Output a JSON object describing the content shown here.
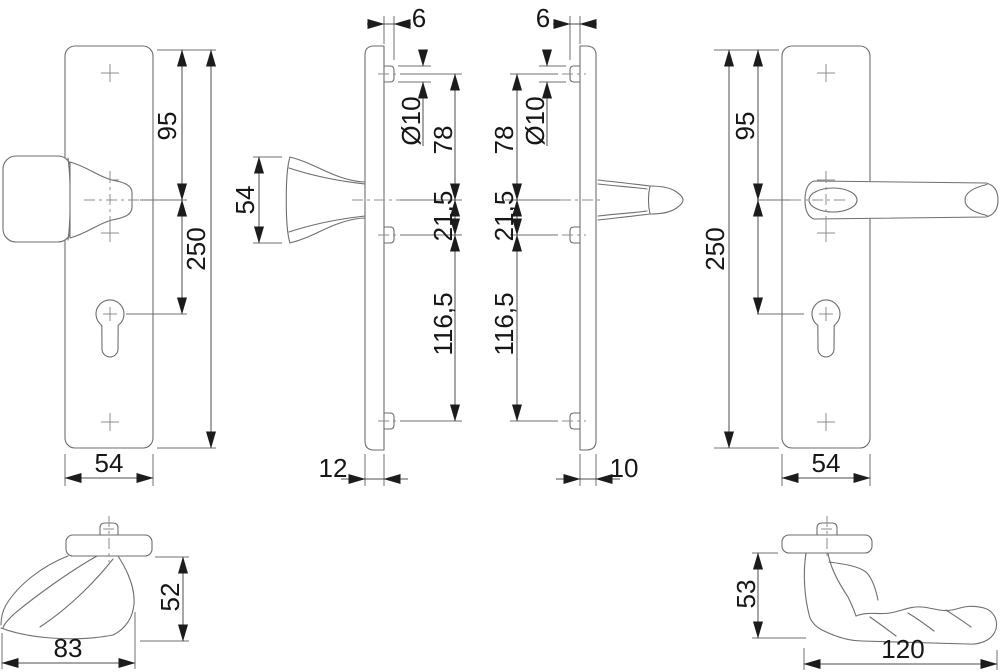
{
  "drawing": {
    "colors": {
      "background": "#ffffff",
      "geometry_line": "#6e6e6e",
      "dimension_line": "#4d4d4d",
      "text": "#161616"
    },
    "views": {
      "front_knob": {
        "labels": {
          "top_to_handle": "95",
          "plate_height": "250",
          "plate_width": "54"
        }
      },
      "side_knob": {
        "labels": {
          "bushing_protrusion": "6",
          "bushing_diameter": "Ø10",
          "knob_height": "54",
          "top_to_handle": "78",
          "handle_to_fixing": "21,5",
          "fixing_to_bottom": "116,5",
          "plate_depth": "12"
        }
      },
      "side_lever": {
        "labels": {
          "bushing_protrusion": "6",
          "bushing_diameter": "Ø10",
          "top_to_handle": "78",
          "handle_to_fixing": "21,5",
          "fixing_to_bottom": "116,5",
          "plate_depth": "10"
        }
      },
      "front_lever": {
        "labels": {
          "top_to_handle": "95",
          "plate_height": "250",
          "plate_width": "54"
        }
      },
      "top_knob": {
        "labels": {
          "projection": "52",
          "grip_width": "83"
        }
      },
      "top_lever": {
        "labels": {
          "projection": "53",
          "grip_length": "120"
        }
      }
    }
  }
}
